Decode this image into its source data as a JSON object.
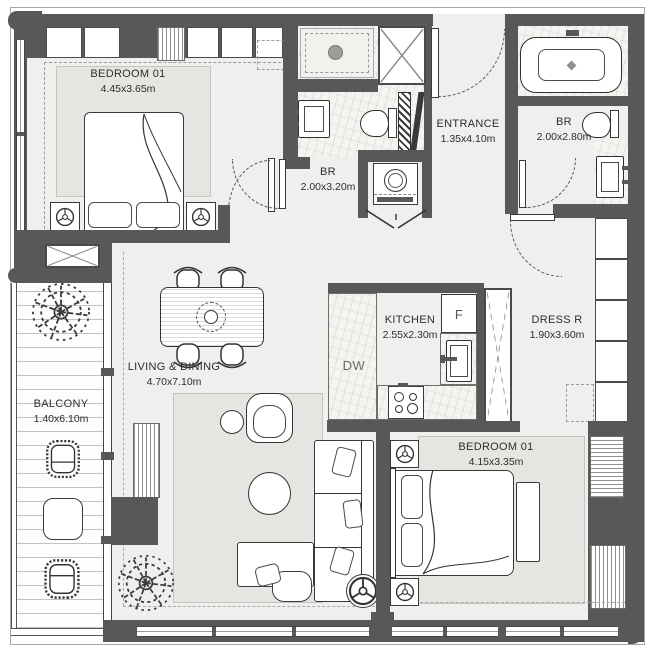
{
  "rooms": [
    {
      "name": "BEDROOM 01",
      "dims": "4.45x3.65m"
    },
    {
      "name": "ENTRANCE",
      "dims": "1.35x4.10m"
    },
    {
      "name": "BR",
      "dims": "2.00x2.80m"
    },
    {
      "name": "BR",
      "dims": "2.00x3.20m"
    },
    {
      "name": "KITCHEN",
      "dims": "2.55x2.30m"
    },
    {
      "name": "DRESS R",
      "dims": "1.90x3.60m"
    },
    {
      "name": "LIVING & DINING",
      "dims": "4.70x7.10m"
    },
    {
      "name": "BALCONY",
      "dims": "1.40x6.10m"
    },
    {
      "name": "BEDROOM 01",
      "dims": "4.15x3.35m"
    }
  ],
  "appliances": {
    "fridge": "F",
    "dishwasher": "DW"
  },
  "colors": {
    "wall": "#57585a",
    "floor": "#f0efed",
    "rug": "#e5e5e2",
    "line": "#333333"
  }
}
